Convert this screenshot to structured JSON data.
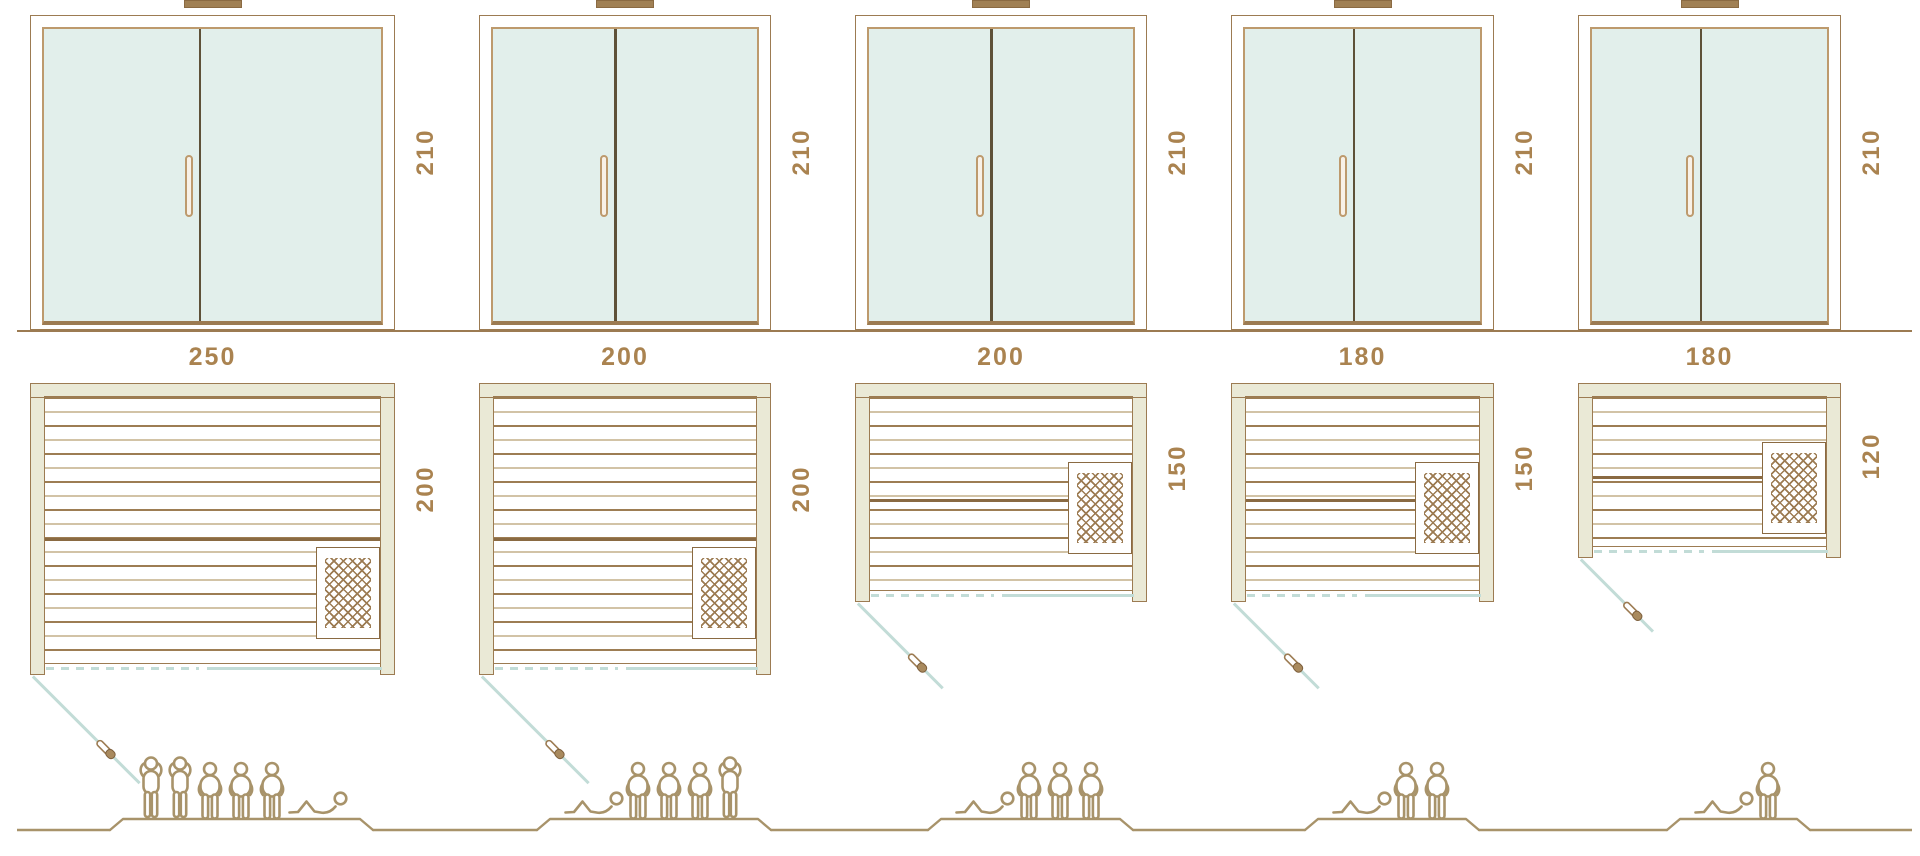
{
  "diagram": {
    "type": "sauna-size-comparison",
    "views": [
      "front-elevation",
      "floor-plan",
      "capacity-figures"
    ],
    "door_height_label": "210"
  },
  "colors": {
    "line_brown": "#9c7b52",
    "dark_brown": "#8a6a42",
    "label_brown": "#aa8350",
    "glass_mint": "#e2efeb",
    "wall_beige": "#eae9d6",
    "teal_line": "#c2dcd7",
    "figure_brown": "#a8936a",
    "plank_light": "#d2c3a6"
  },
  "columns": [
    {
      "name": "sauna-250x200",
      "height_label": "210",
      "width_label": "250",
      "depth_label": "200",
      "height_cm": 210,
      "width_cm": 250,
      "depth_cm": 200,
      "capacity": 6,
      "people": [
        "standing",
        "standing",
        "sitting",
        "sitting",
        "sitting",
        "lying"
      ]
    },
    {
      "name": "sauna-200x200",
      "height_label": "210",
      "width_label": "200",
      "depth_label": "200",
      "height_cm": 210,
      "width_cm": 200,
      "depth_cm": 200,
      "capacity": 5,
      "people": [
        "lying",
        "sitting",
        "sitting",
        "sitting",
        "standing"
      ]
    },
    {
      "name": "sauna-200x150",
      "height_label": "210",
      "width_label": "200",
      "depth_label": "150",
      "height_cm": 210,
      "width_cm": 200,
      "depth_cm": 150,
      "capacity": 4,
      "people": [
        "lying",
        "sitting",
        "sitting",
        "sitting"
      ]
    },
    {
      "name": "sauna-180x150",
      "height_label": "210",
      "width_label": "180",
      "depth_label": "150",
      "height_cm": 210,
      "width_cm": 180,
      "depth_cm": 150,
      "capacity": 3,
      "people": [
        "lying",
        "sitting",
        "sitting"
      ]
    },
    {
      "name": "sauna-180x120",
      "height_label": "210",
      "width_label": "180",
      "depth_label": "120",
      "height_cm": 210,
      "width_cm": 180,
      "depth_cm": 120,
      "capacity": 2,
      "people": [
        "lying",
        "sitting"
      ]
    }
  ]
}
